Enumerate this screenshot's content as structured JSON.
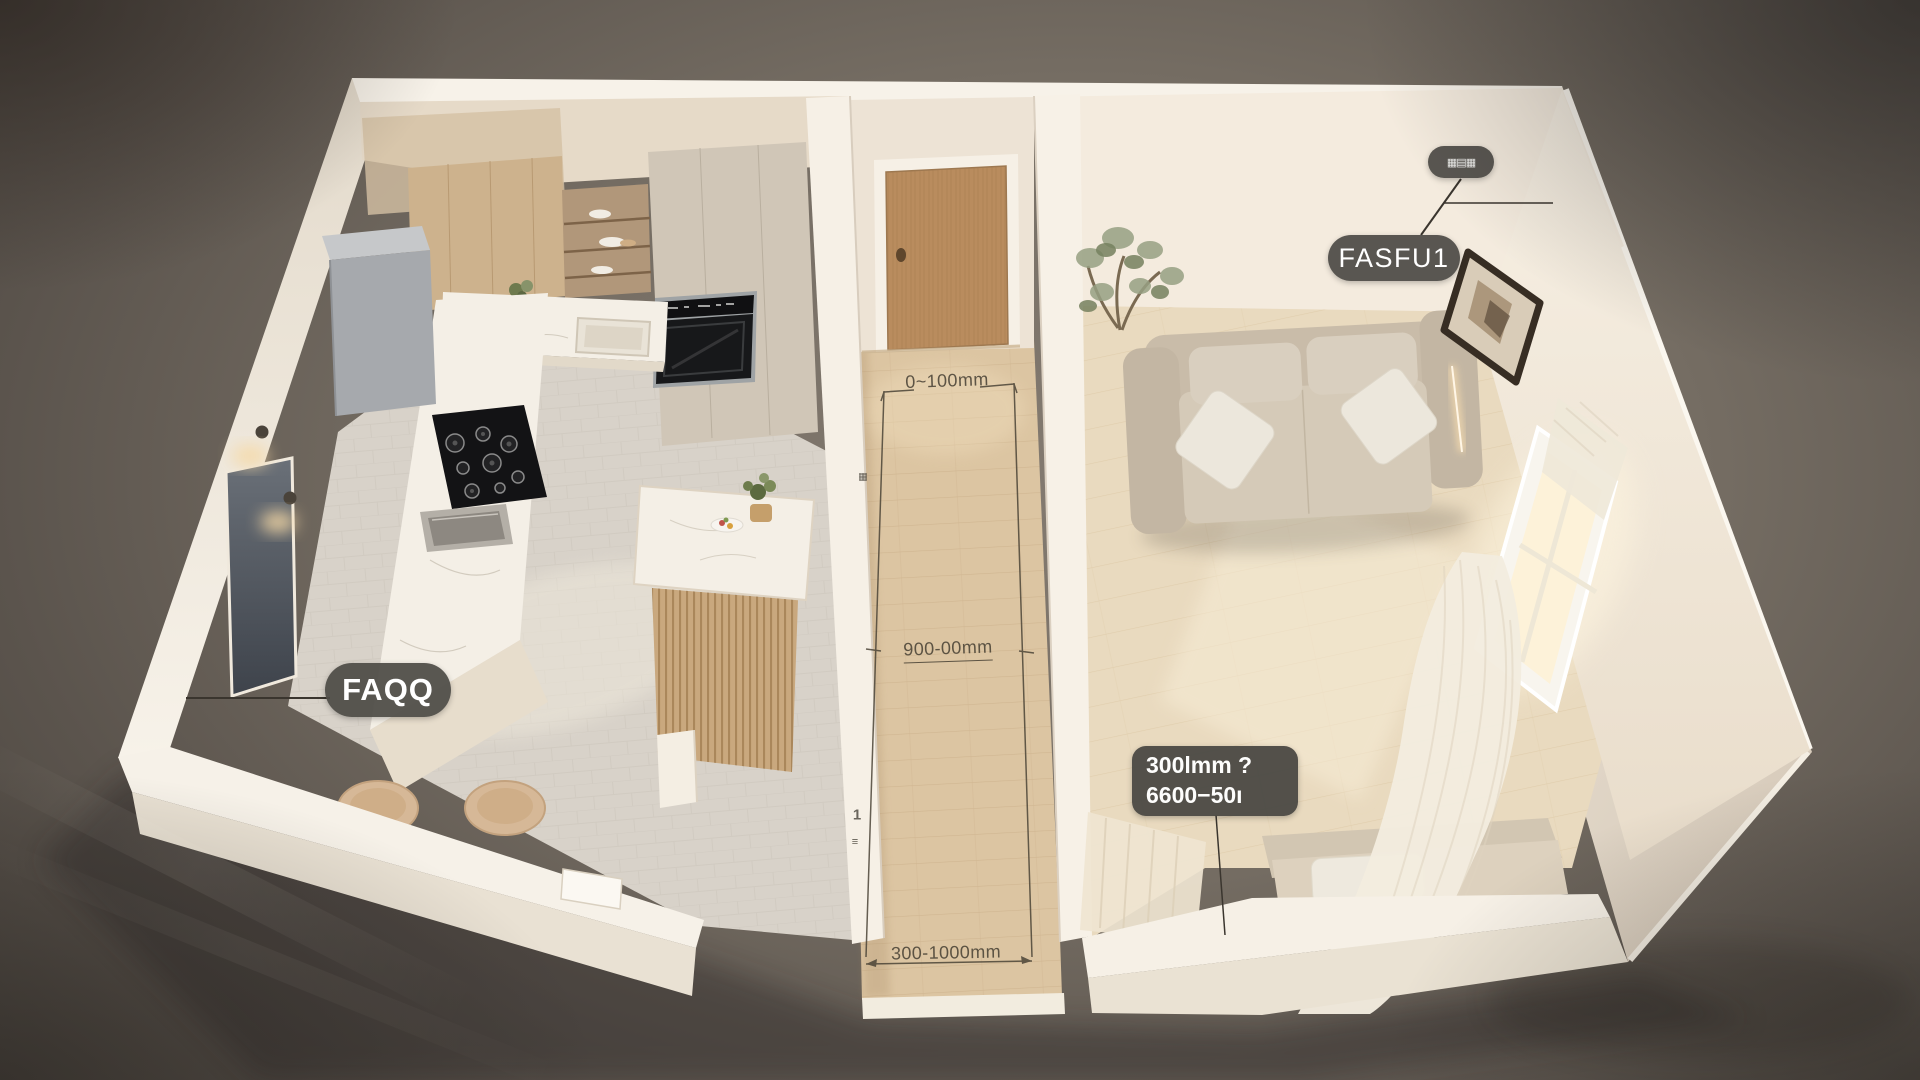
{
  "scene_labels": {
    "chip_top": {
      "text": "▦▤▦"
    },
    "room_tag_right": {
      "text": "FASFU1"
    },
    "room_tag_left": {
      "text": "FAQQ"
    },
    "info_box": {
      "line1": "300lmm ?",
      "line2": "6600−50ı"
    },
    "dimensions": {
      "top": "0~100mm",
      "middle": "900-00mm",
      "bottom": "300-1000mm"
    },
    "wall_marks": {
      "upper": "▦",
      "lower_number": "1",
      "lower_glyph": "≡"
    }
  },
  "palette": {
    "background": "#6f675e",
    "tag_background": "#514f4a",
    "tag_text": "#ffffff",
    "dimension_text": "#4b4437",
    "wall": "#f2e9dd",
    "kitchen_floor": "#d8d2c9",
    "hall_floor": "#dcc5a2",
    "living_floor": "#e9dabf",
    "marble": "#f4efe6",
    "island_wood": "#c9a87e",
    "door_wood": "#b98c5e",
    "sofa": "#cfc4b2",
    "appliance_gray": "#a6a9ad",
    "cooktop_black": "#131315"
  }
}
